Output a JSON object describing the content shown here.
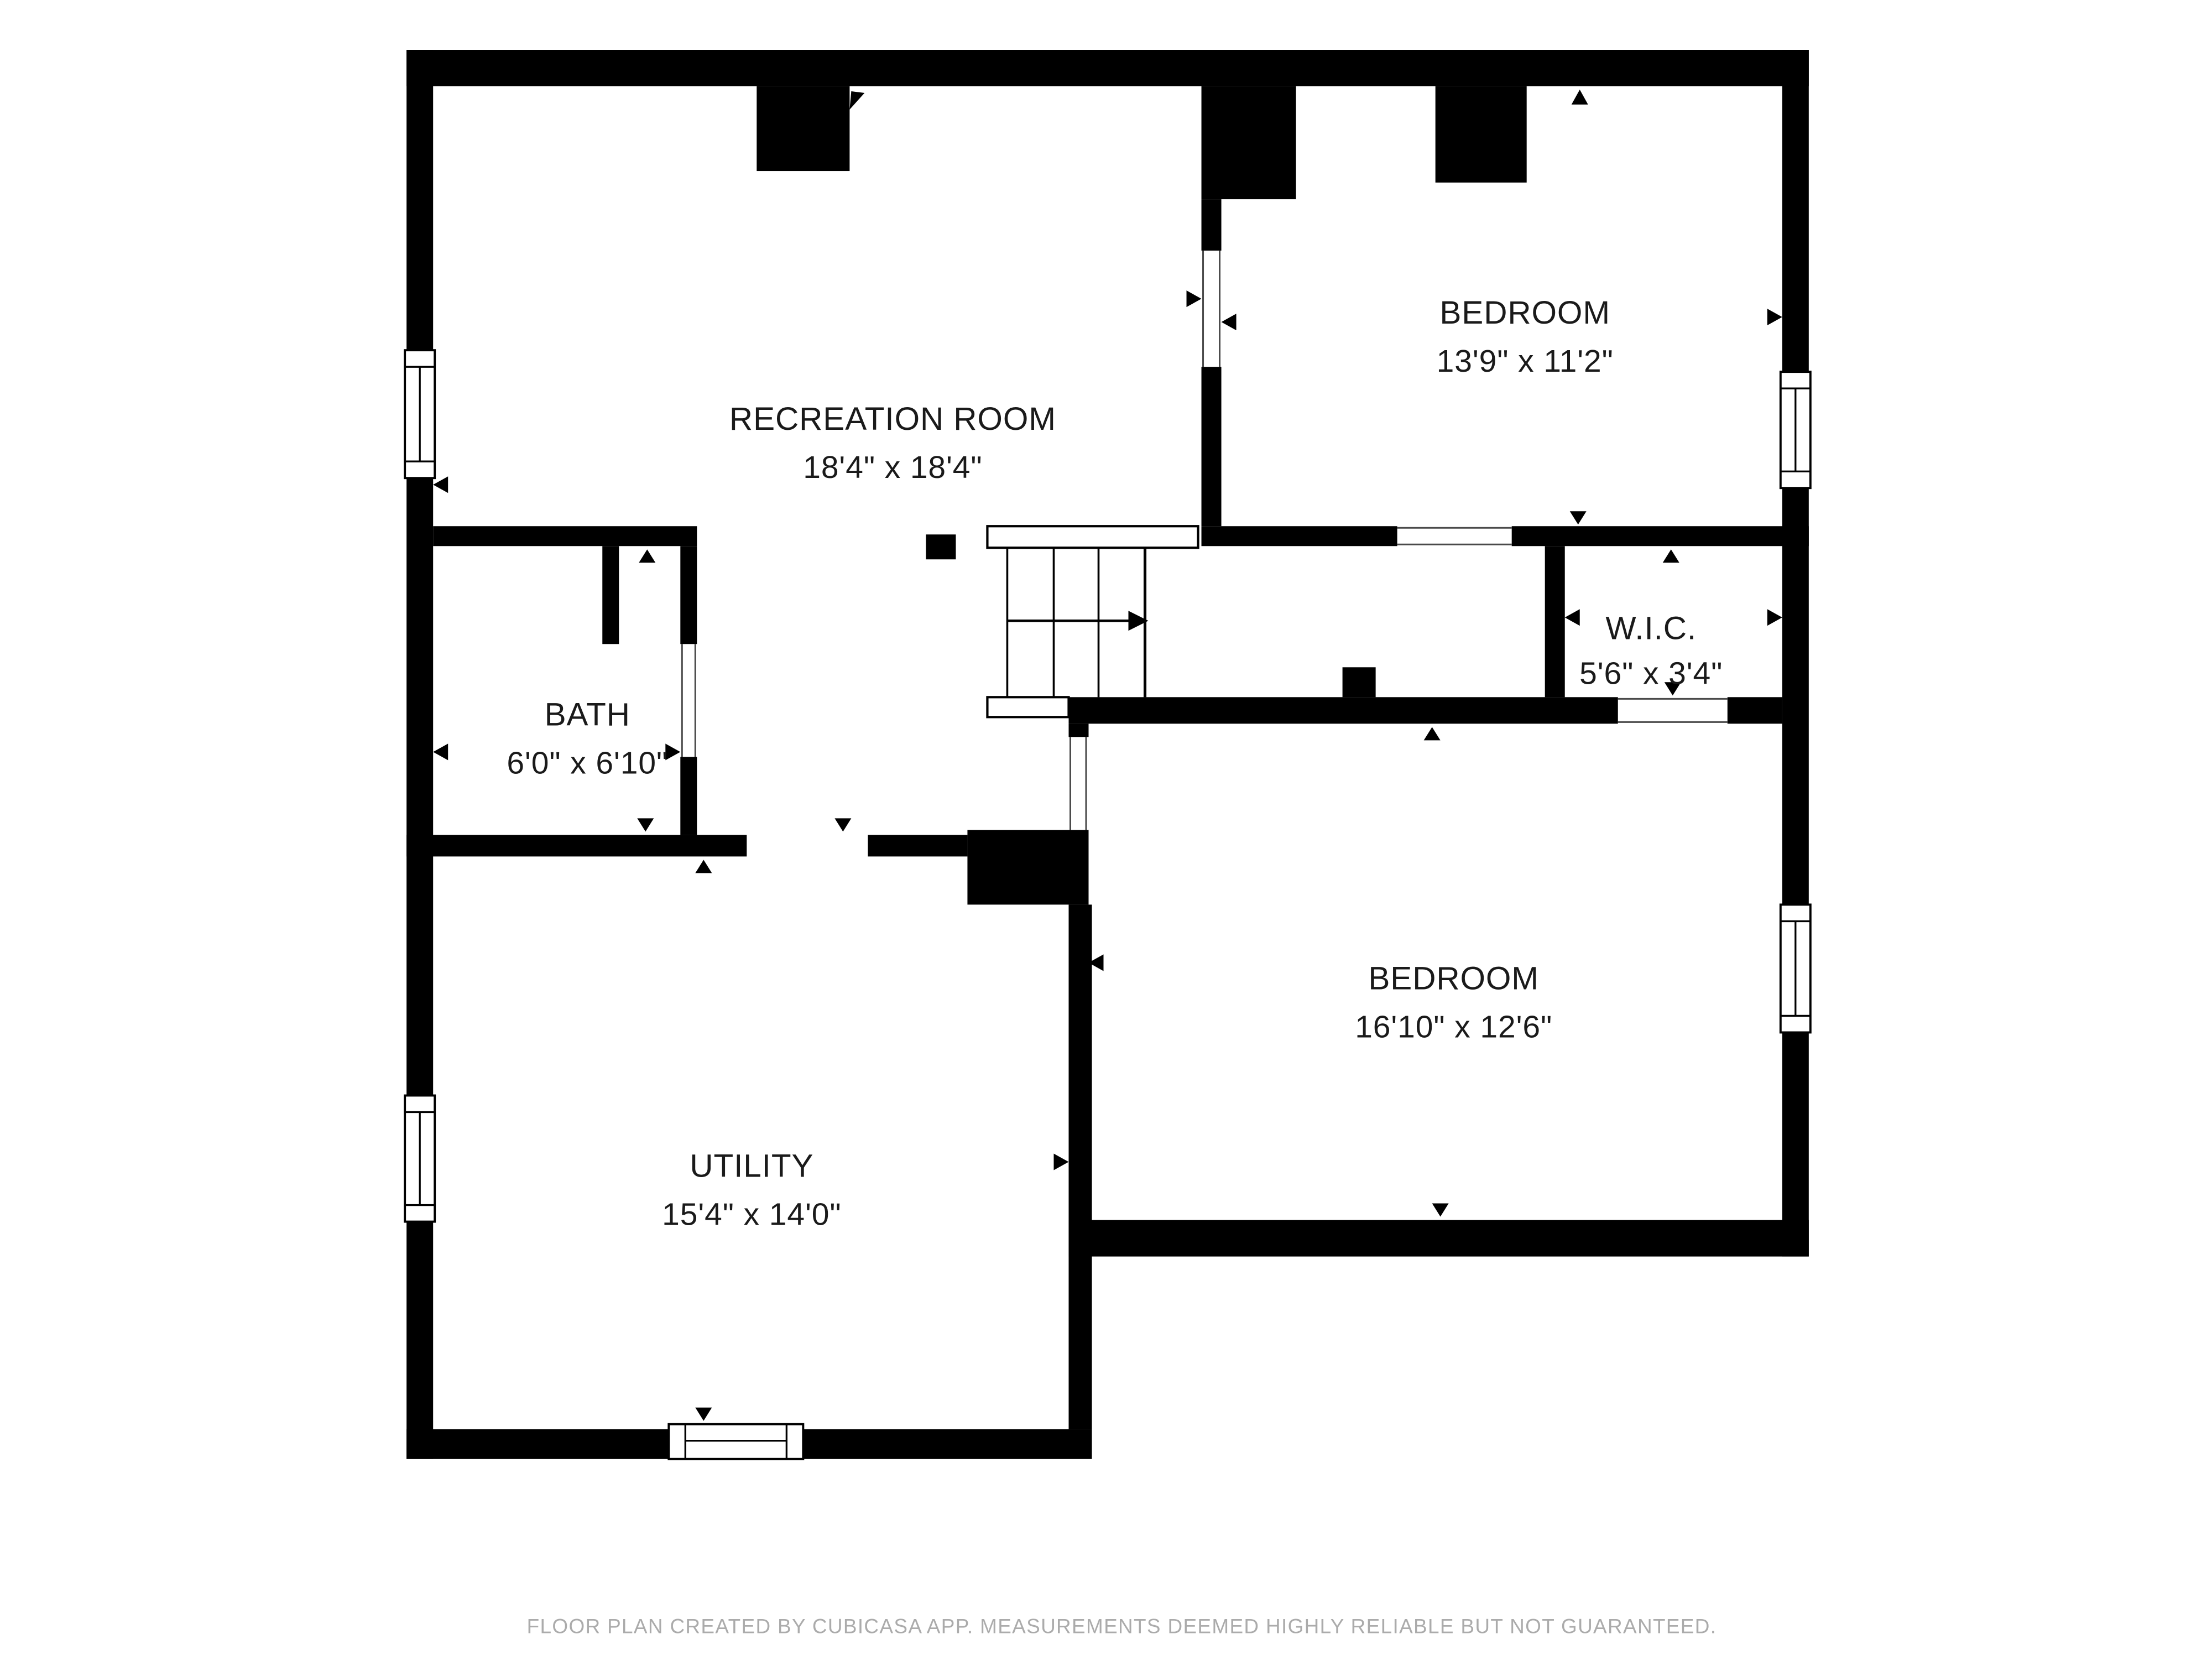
{
  "rooms": [
    {
      "id": "recreation-room",
      "name": "RECREATION ROOM",
      "dimensions": "18'4\" x 18'4\""
    },
    {
      "id": "bedroom-top",
      "name": "BEDROOM",
      "dimensions": "13'9\" x 11'2\""
    },
    {
      "id": "bath",
      "name": "BATH",
      "dimensions": "6'0\" x 6'10\""
    },
    {
      "id": "wic",
      "name": "W.I.C.",
      "dimensions": "5'6\" x 3'4\""
    },
    {
      "id": "bedroom-bottom",
      "name": "BEDROOM",
      "dimensions": "16'10\" x 12'6\""
    },
    {
      "id": "utility",
      "name": "UTILITY",
      "dimensions": "15'4\" x 14'0\""
    }
  ],
  "footer": "FLOOR PLAN CREATED BY CUBICASA APP. MEASUREMENTS DEEMED HIGHLY RELIABLE BUT NOT GUARANTEED.",
  "colors": {
    "wall": "#000000",
    "background": "#ffffff",
    "label_text": "#1a1a1a",
    "footer_text": "#ababab"
  }
}
